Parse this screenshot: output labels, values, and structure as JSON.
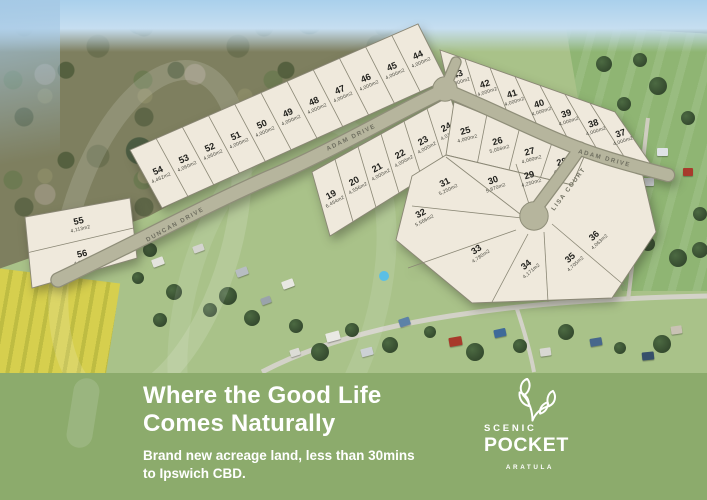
{
  "banner": {
    "headline_line1": "Where the Good Life",
    "headline_line2": "Comes Naturally",
    "subline_line1": "Brand new acreage land, less than 30mins",
    "subline_line2": "to Ipswich CBD.",
    "background_color": "#8cab6c",
    "text_color": "#ffffff"
  },
  "logo": {
    "brand_top": "SCENIC",
    "brand_main": "POCKET",
    "brand_sub": "ARATULA",
    "icon": "leaf-sprig-icon"
  },
  "plan": {
    "lot_fill": "#efe9dc",
    "road_fill": "#b6b59d",
    "roads": [
      {
        "name": "DUNCAN DRIVE"
      },
      {
        "name": "ADAM DRIVE"
      },
      {
        "name": "ADAM DRIVE"
      },
      {
        "name": "LISA COURT"
      }
    ],
    "lots": [
      {
        "number": "19",
        "size": "6,454m2"
      },
      {
        "number": "20",
        "size": "4,556m2"
      },
      {
        "number": "21",
        "size": "4,000m2"
      },
      {
        "number": "22",
        "size": "4,000m2"
      },
      {
        "number": "23",
        "size": "4,000m2"
      },
      {
        "number": "24",
        "size": "4,016m2"
      },
      {
        "number": "25",
        "size": "4,000m2"
      },
      {
        "number": "26",
        "size": "5,056m2"
      },
      {
        "number": "27",
        "size": "4,000m2"
      },
      {
        "number": "28",
        "size": "4,000m2"
      },
      {
        "number": "29",
        "size": "4,250m2"
      },
      {
        "number": "30",
        "size": "5,870m2"
      },
      {
        "number": "31",
        "size": "5,250m2"
      },
      {
        "number": "32",
        "size": "5,566m2"
      },
      {
        "number": "33",
        "size": "4,780m2"
      },
      {
        "number": "34",
        "size": "4,171m2"
      },
      {
        "number": "35",
        "size": "4,705m2"
      },
      {
        "number": "36",
        "size": "4,063m2"
      },
      {
        "number": "37",
        "size": "4,000m2"
      },
      {
        "number": "38",
        "size": "4,000m2"
      },
      {
        "number": "39",
        "size": "4,000m2"
      },
      {
        "number": "40",
        "size": "4,000m2"
      },
      {
        "number": "41",
        "size": "4,000m2"
      },
      {
        "number": "42",
        "size": "4,000m2"
      },
      {
        "number": "43",
        "size": "4,000m2"
      },
      {
        "number": "44",
        "size": "4,000m2"
      },
      {
        "number": "45",
        "size": "4,000m2"
      },
      {
        "number": "46",
        "size": "4,000m2"
      },
      {
        "number": "47",
        "size": "4,000m2"
      },
      {
        "number": "48",
        "size": "4,000m2"
      },
      {
        "number": "49",
        "size": "4,000m2"
      },
      {
        "number": "50",
        "size": "4,000m2"
      },
      {
        "number": "51",
        "size": "4,000m2"
      },
      {
        "number": "52",
        "size": "4,060m2"
      },
      {
        "number": "53",
        "size": "4,060m2"
      },
      {
        "number": "54",
        "size": "4,462m2"
      },
      {
        "number": "55",
        "size": "4,113m2"
      },
      {
        "number": "56",
        "size": "4,121m2"
      }
    ]
  }
}
